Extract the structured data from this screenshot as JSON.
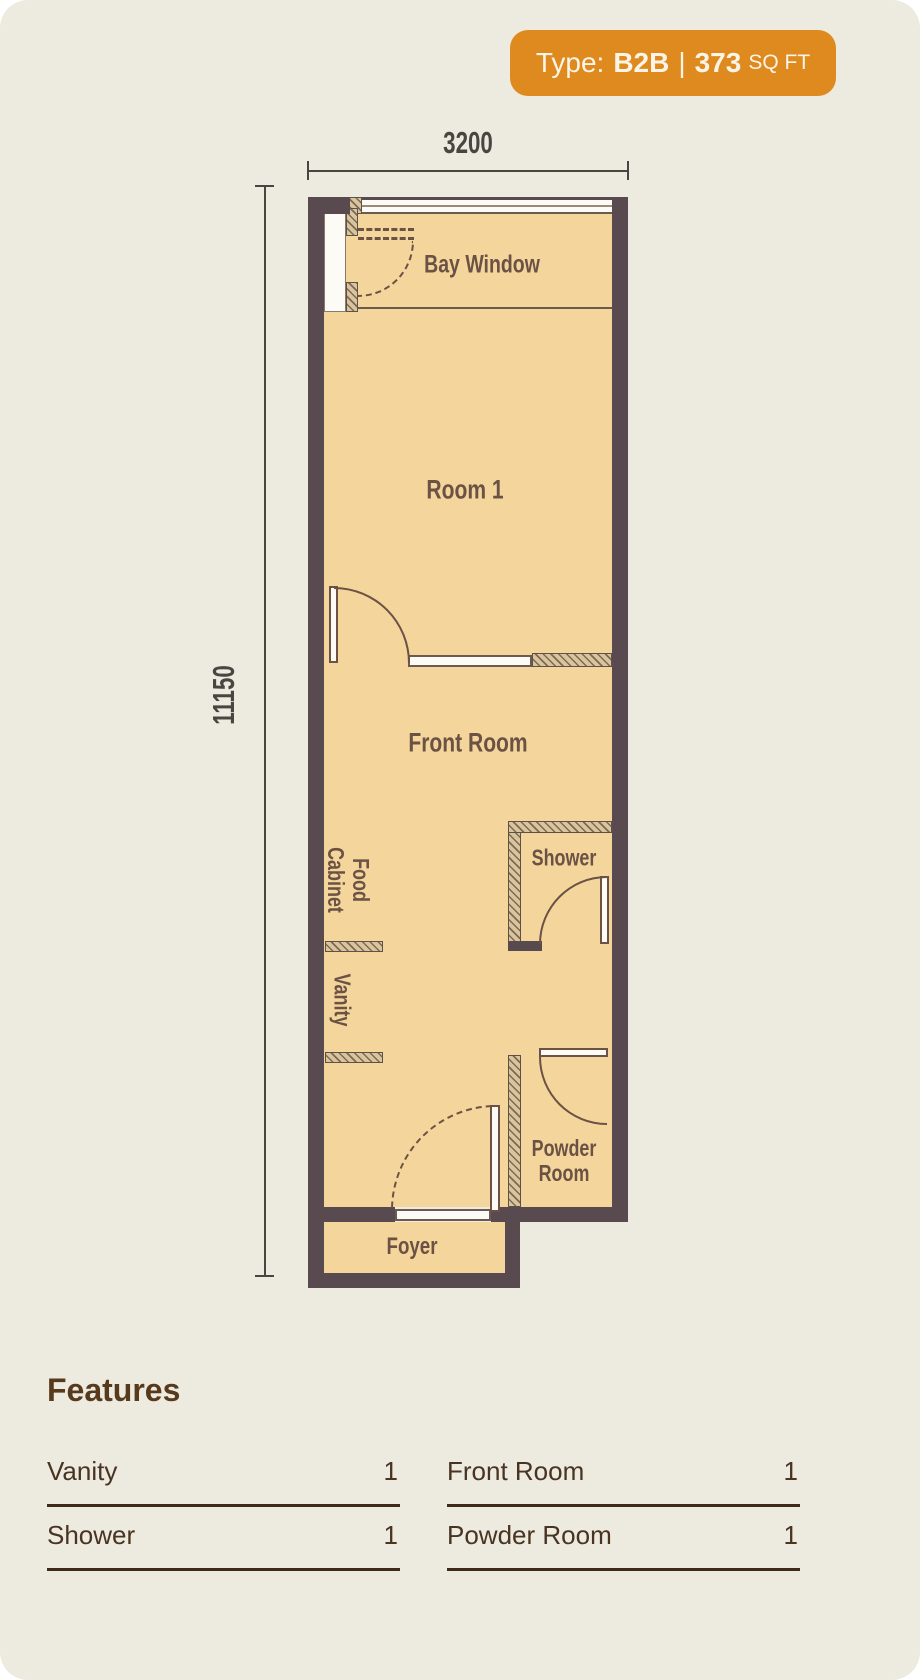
{
  "badge": {
    "prefix": "Type:",
    "type": "B2B",
    "divider": "|",
    "area": "373",
    "unit": "SQ FT"
  },
  "dimensions": {
    "width": "3200",
    "height": "11150"
  },
  "rooms": {
    "bay_window": "Bay Window",
    "room1": "Room 1",
    "front_room": "Front Room",
    "food_cabinet": "Food\nCabinet",
    "vanity": "Vanity",
    "shower": "Shower",
    "powder_room": "Powder\nRoom",
    "foyer": "Foyer"
  },
  "features": {
    "heading": "Features",
    "items": [
      {
        "name": "Vanity",
        "count": "1"
      },
      {
        "name": "Shower",
        "count": "1"
      },
      {
        "name": "Front Room",
        "count": "1"
      },
      {
        "name": "Powder Room",
        "count": "1"
      }
    ]
  },
  "colors": {
    "accent": "#de8a1e",
    "wall": "#594a50",
    "floor": "#f4d69c",
    "line_brown": "#6b5244",
    "background": "#edeae0",
    "feature_text": "#493321"
  }
}
